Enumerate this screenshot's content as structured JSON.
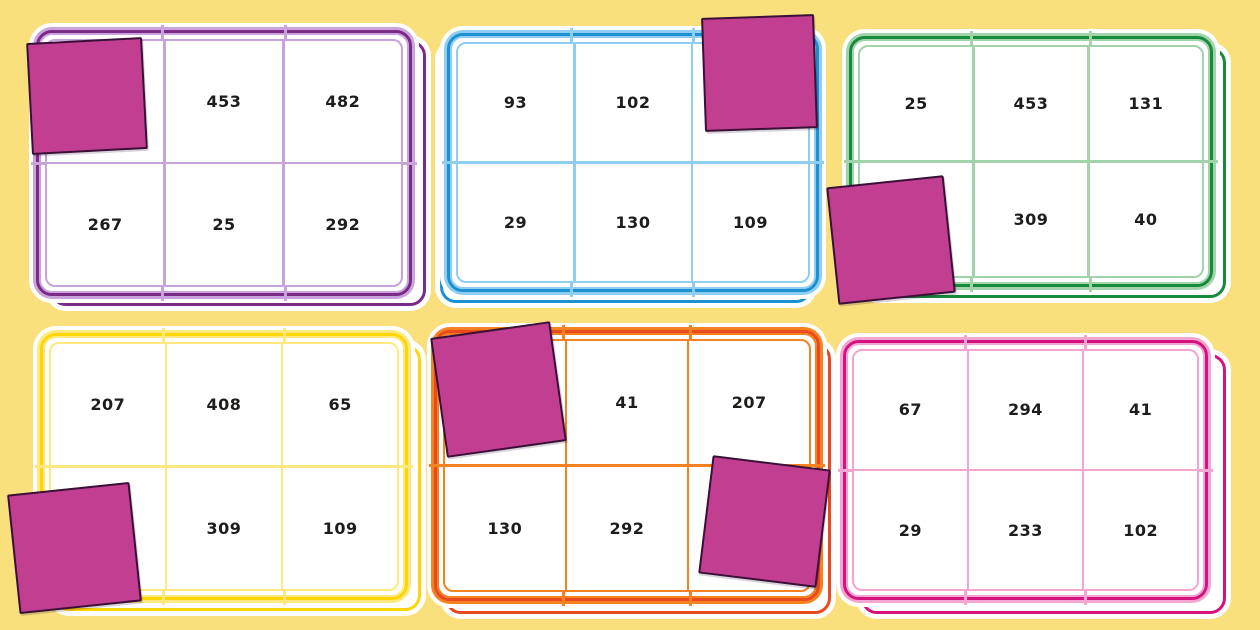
{
  "title": "Number bingo cards with counters",
  "background": "#F9E07D",
  "number_color": "#1D1D1B",
  "counter": {
    "fill": "#C23E90",
    "border": "#3A1038"
  },
  "cards": [
    {
      "id": "purple",
      "colors": {
        "dark": "#7B2A87",
        "light": "#C9A3DB"
      },
      "cells": [
        "",
        "453",
        "482",
        "267",
        "25",
        "292"
      ],
      "covered_cells": [
        0
      ]
    },
    {
      "id": "blue",
      "colors": {
        "dark": "#1B90D2",
        "light": "#8FCEF0"
      },
      "cells": [
        "93",
        "102",
        "",
        "29",
        "130",
        "109"
      ],
      "covered_cells": [
        2
      ]
    },
    {
      "id": "green",
      "colors": {
        "dark": "#178B3C",
        "light": "#A3D3AB"
      },
      "cells": [
        "25",
        "453",
        "131",
        "",
        "309",
        "40"
      ],
      "covered_cells": [
        3
      ]
    },
    {
      "id": "yellow",
      "colors": {
        "dark": "#FFD503",
        "light": "#FFE97E"
      },
      "cells": [
        "207",
        "408",
        "65",
        "",
        "309",
        "109"
      ],
      "covered_cells": [
        3
      ]
    },
    {
      "id": "orange",
      "colors": {
        "dark": "#E8491D",
        "light": "#F58220"
      },
      "cells": [
        "",
        "41",
        "207",
        "130",
        "292",
        ""
      ],
      "covered_cells": [
        0,
        5
      ]
    },
    {
      "id": "pink",
      "colors": {
        "dark": "#D5137F",
        "light": "#F4A6D2"
      },
      "cells": [
        "67",
        "294",
        "41",
        "29",
        "233",
        "102"
      ],
      "covered_cells": []
    }
  ]
}
